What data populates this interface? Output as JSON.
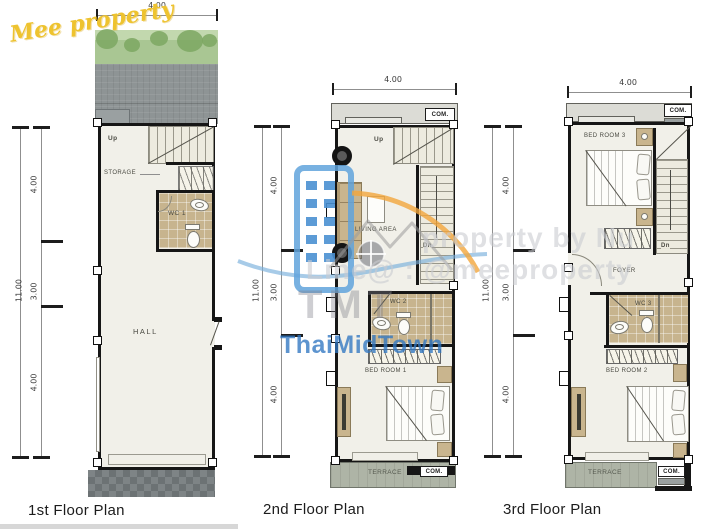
{
  "watermarks": {
    "script": "Mee property",
    "tmt": "TMT",
    "thaimidtown": "ThaiMidTown",
    "line1": "property by Nu",
    "line2": "Line@ : @meeproperty"
  },
  "colors": {
    "brand_yellow": "#e9bd2e",
    "watermark_blue": "#4a90c9",
    "watermark_orange": "#f0a43c",
    "wall_black": "#161616",
    "floor_cream": "#f1f0e9",
    "grass_green": "#abc795",
    "tile_tan": "#c7b48e"
  },
  "plans": [
    {
      "title": "1st Floor Plan",
      "width_label": "4.00",
      "height_total": "11.00",
      "segments": [
        "4.00",
        "3.00",
        "4.00"
      ],
      "labels": {
        "up": "Up",
        "storage": "STORAGE",
        "wc": "WC 1",
        "hall": "HALL"
      }
    },
    {
      "title": "2nd Floor Plan",
      "width_label": "4.00",
      "height_total": "11.00",
      "segments": [
        "4.00",
        "3.00",
        "4.00"
      ],
      "com_top": "COM.",
      "com_bottom": "COM.",
      "labels": {
        "up": "Up",
        "dn": "Dn",
        "living": "LIVING AREA",
        "wc": "WC 2",
        "bedroom": "BED ROOM 1",
        "terrace": "TERRACE"
      }
    },
    {
      "title": "3rd Floor Plan",
      "width_label": "4.00",
      "height_total": "11.00",
      "segments": [
        "4.00",
        "3.00",
        "4.00"
      ],
      "com_top": "COM.",
      "com_bottom": "COM.",
      "labels": {
        "dn": "Dn",
        "bedroom3": "BED ROOM 3",
        "foyer": "FOYER",
        "wc": "WC 3",
        "bedroom2": "BED ROOM 2",
        "terrace": "TERRACE"
      }
    }
  ]
}
